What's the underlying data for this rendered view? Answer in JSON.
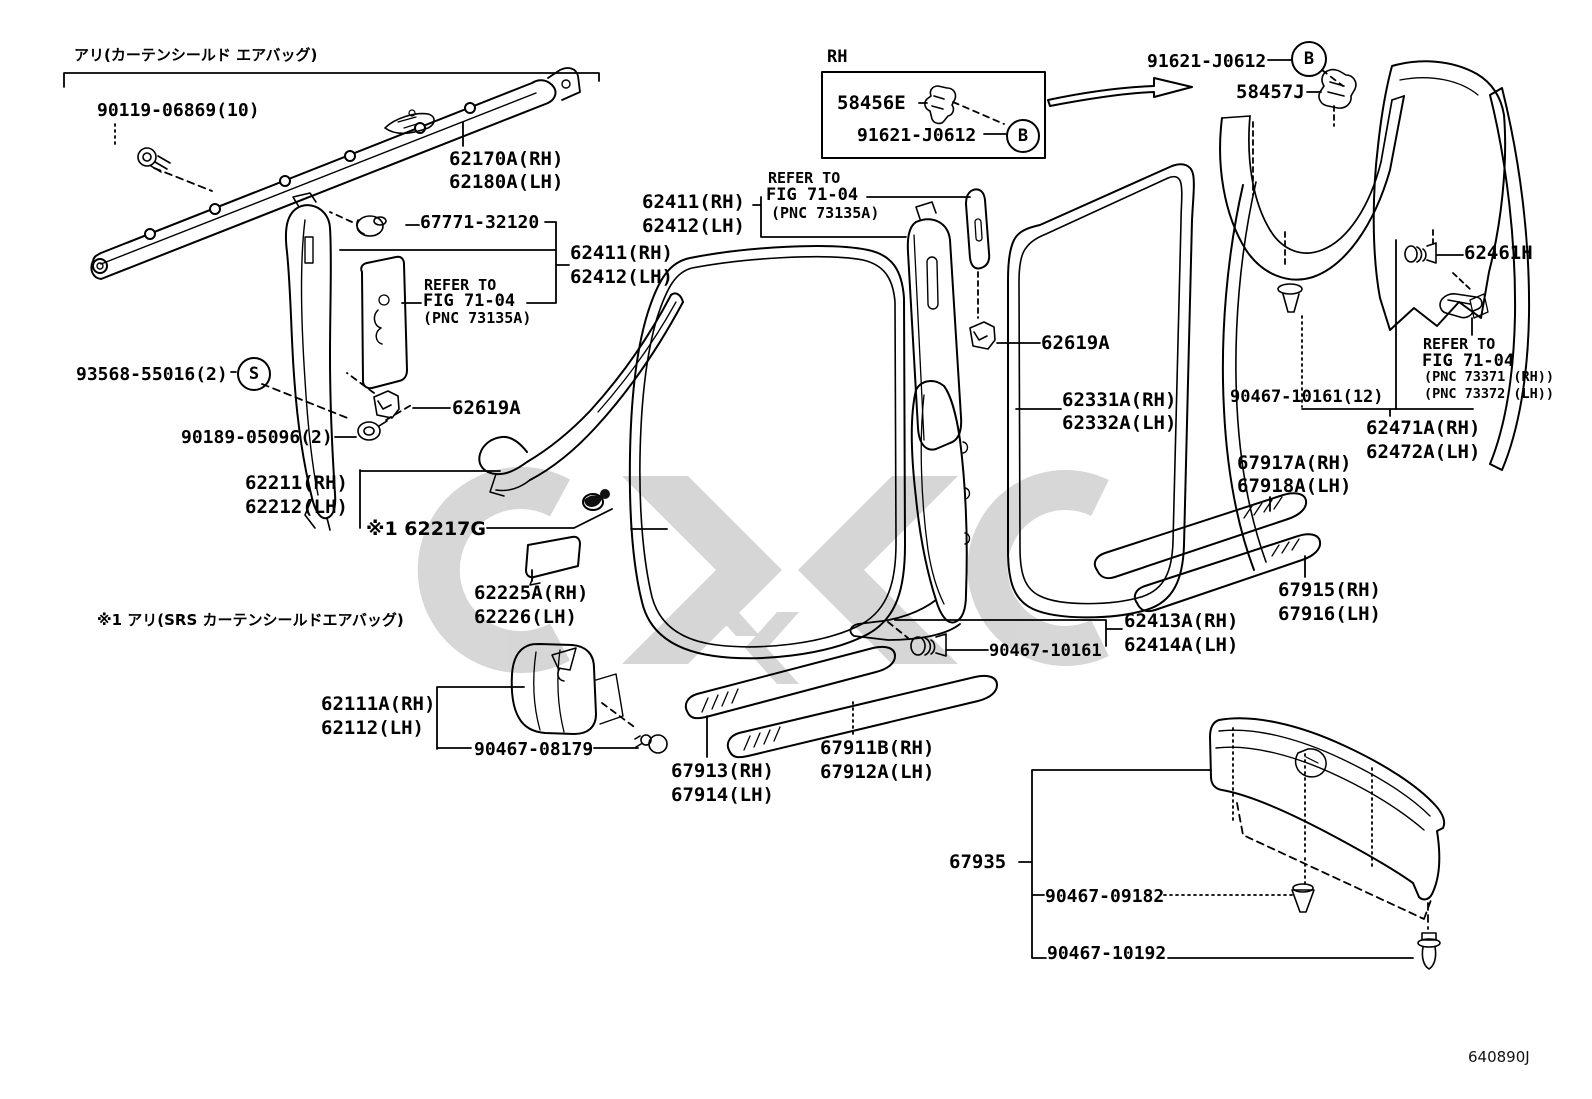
{
  "colors": {
    "ink": "#000000",
    "paper": "#ffffff",
    "watermark": "#c9c9c9"
  },
  "badges": {
    "s": "S",
    "b": "B"
  },
  "notes": {
    "airbag": "アリ(カーテンシールド エアバッグ)",
    "srs": "※1 アリ(SRS カーテンシールドエアバッグ)",
    "rh": "RH",
    "drawing_code": "640890J"
  },
  "labels": {
    "n90119": "90119-06869(10)",
    "n62170a": "62170A(RH)",
    "n62180a": "62180A(LH)",
    "n67771": "67771-32120",
    "n62411_l": "62411(RH)",
    "n62412_l": "62412(LH)",
    "refer1_line1": "REFER TO",
    "refer1_line2": "FIG 71-04",
    "refer1_line3": "(PNC 73135A)",
    "n93568": "93568-55016(2)",
    "n90189": "90189-05096(2)",
    "n62619a_left": "62619A",
    "n62211": "62211(RH)",
    "n62212": "62212(LH)",
    "n62217g": "※1 62217G",
    "n62225a": "62225A(RH)",
    "n62226": "62226(LH)",
    "n62111a": "62111A(RH)",
    "n62112": "62112(LH)",
    "n90467_08179": "90467-08179",
    "n67913": "67913(RH)",
    "n67914": "67914(LH)",
    "n67911b": "67911B(RH)",
    "n67912a": "67912A(LH)",
    "n58456e": "58456E",
    "n91621_box": "91621-J0612",
    "n62411_c": "62411(RH)",
    "n62412_c": "62412(LH)",
    "refer2_line1": "REFER TO",
    "refer2_line2": "FIG 71-04",
    "refer2_line3": "(PNC 73135A)",
    "n62619a_center": "62619A",
    "n62331a": "62331A(RH)",
    "n62332a": "62332A(LH)",
    "n90467_10161": "90467-10161",
    "n62413a": "62413A(RH)",
    "n62414a": "62414A(LH)",
    "n91621_tr": "91621-J0612",
    "n58457j": "58457J",
    "n62461h": "62461H",
    "n90467_10161_12": "90467-10161(12)",
    "refer3_line1": "REFER TO",
    "refer3_line2": "FIG 71-04",
    "refer3_line3": "(PNC 73371 (RH))",
    "refer3_line4": "(PNC 73372 (LH))",
    "n62471a": "62471A(RH)",
    "n62472a": "62472A(LH)",
    "n67917a": "67917A(RH)",
    "n67918a": "67918A(LH)",
    "n67915": "67915(RH)",
    "n67916": "67916(LH)",
    "n67935": "67935",
    "n90467_09182": "90467-09182",
    "n90467_10192": "90467-10192"
  }
}
